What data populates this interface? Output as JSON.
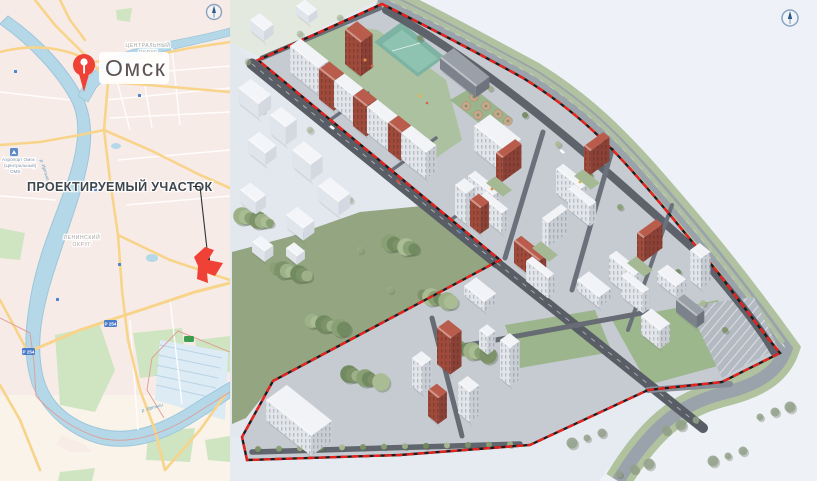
{
  "map": {
    "city": "Омск",
    "central_district": [
      "ЦЕНТРАЛЬНЫЙ",
      "ОКРУГ"
    ],
    "leninsky_district": [
      "ЛЕНИНСКИЙ",
      "ОКРУГ"
    ],
    "airport": [
      "Аэропорт Омск",
      "(Центральный)",
      "OMS"
    ],
    "callout": "ПРОЕКТИРУЕМЫЙ УЧАСТОК",
    "river_label": "р. Иртыш",
    "road_badge": "Р 254"
  },
  "colors": {
    "accent-red": "#e8231d",
    "pin-red": "#ef4136",
    "map-land": "#f7ebe7",
    "map-water": "#b5d8e8",
    "map-road": "#f8d48a",
    "map-green": "#cfe5c2",
    "forest-green": "#8ba277",
    "brick-red": "#a04a3c",
    "compass-blue": "#2b5c8f"
  }
}
